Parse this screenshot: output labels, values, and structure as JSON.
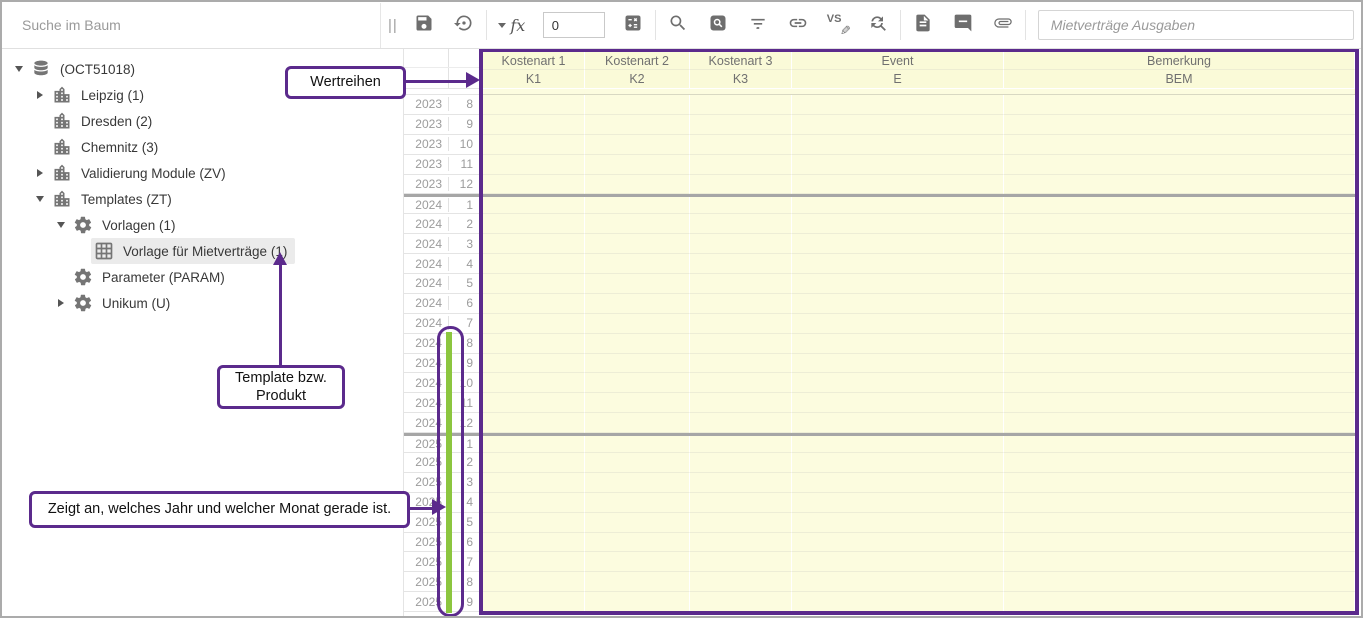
{
  "toolbar": {
    "search_placeholder": "Suche im Baum",
    "splitter": "||",
    "formula_label": "fx",
    "value_field": "0",
    "compare_label": "VS",
    "name_field_placeholder": "Mietverträge Ausgaben",
    "icons": [
      "save",
      "history",
      "formula-dropdown",
      "calculator",
      "search",
      "find-in-grid",
      "filter",
      "link",
      "compare-edit",
      "refresh-search",
      "document",
      "comment",
      "attachment"
    ]
  },
  "tree": {
    "items": [
      {
        "label": "(OCT51018)",
        "level": 0,
        "expand": "open",
        "icon": "database",
        "selected": false
      },
      {
        "label": "Leipzig (1)",
        "level": 1,
        "expand": "closed",
        "icon": "building",
        "selected": false
      },
      {
        "label": "Dresden (2)",
        "level": 1,
        "expand": "none",
        "icon": "building",
        "selected": false
      },
      {
        "label": "Chemnitz (3)",
        "level": 1,
        "expand": "none",
        "icon": "building",
        "selected": false
      },
      {
        "label": "Validierung Module (ZV)",
        "level": 1,
        "expand": "closed",
        "icon": "building",
        "selected": false
      },
      {
        "label": "Templates (ZT)",
        "level": 1,
        "expand": "open",
        "icon": "building",
        "selected": false
      },
      {
        "label": "Vorlagen (1)",
        "level": 2,
        "expand": "open",
        "icon": "gear",
        "selected": false
      },
      {
        "label": "Vorlage für Mietverträge (1)",
        "level": 3,
        "expand": "none",
        "icon": "table",
        "selected": true
      },
      {
        "label": "Parameter (PARAM)",
        "level": 2,
        "expand": "none",
        "icon": "gear",
        "selected": false
      },
      {
        "label": "Unikum (U)",
        "level": 2,
        "expand": "closed",
        "icon": "gear",
        "selected": false
      }
    ]
  },
  "grid": {
    "columns": [
      {
        "title": "Kostenart 1",
        "code": "K1"
      },
      {
        "title": "Kostenart 2",
        "code": "K2"
      },
      {
        "title": "Kostenart 3",
        "code": "K3"
      },
      {
        "title": "Event",
        "code": "E"
      },
      {
        "title": "Bemerkung",
        "code": "BEM"
      }
    ],
    "rows": [
      [
        2023,
        8
      ],
      [
        2023,
        9
      ],
      [
        2023,
        10
      ],
      [
        2023,
        11
      ],
      [
        2023,
        12
      ],
      [
        2024,
        1
      ],
      [
        2024,
        2
      ],
      [
        2024,
        3
      ],
      [
        2024,
        4
      ],
      [
        2024,
        5
      ],
      [
        2024,
        6
      ],
      [
        2024,
        7
      ],
      [
        2024,
        8
      ],
      [
        2024,
        9
      ],
      [
        2024,
        10
      ],
      [
        2024,
        11
      ],
      [
        2024,
        12
      ],
      [
        2025,
        1
      ],
      [
        2025,
        2
      ],
      [
        2025,
        3
      ],
      [
        2025,
        4
      ],
      [
        2025,
        5
      ],
      [
        2025,
        6
      ],
      [
        2025,
        7
      ],
      [
        2025,
        8
      ],
      [
        2025,
        9
      ]
    ]
  },
  "annotations": {
    "wertreihen": {
      "text": "Wertreihen"
    },
    "template_product": {
      "text": "Template bzw. Produkt"
    },
    "current_period": {
      "text": "Zeigt an, welches Jahr und welcher Monat gerade ist."
    }
  },
  "colors": {
    "purple": "#5B2A8C",
    "green": "#8CC63F",
    "cell_bg": "#FCFCDF",
    "header_bg": "#FAFAD8",
    "separator": "#A6A6A6",
    "icon_gray": "#6E6E6E",
    "frame_gray": "#ABABAB"
  }
}
